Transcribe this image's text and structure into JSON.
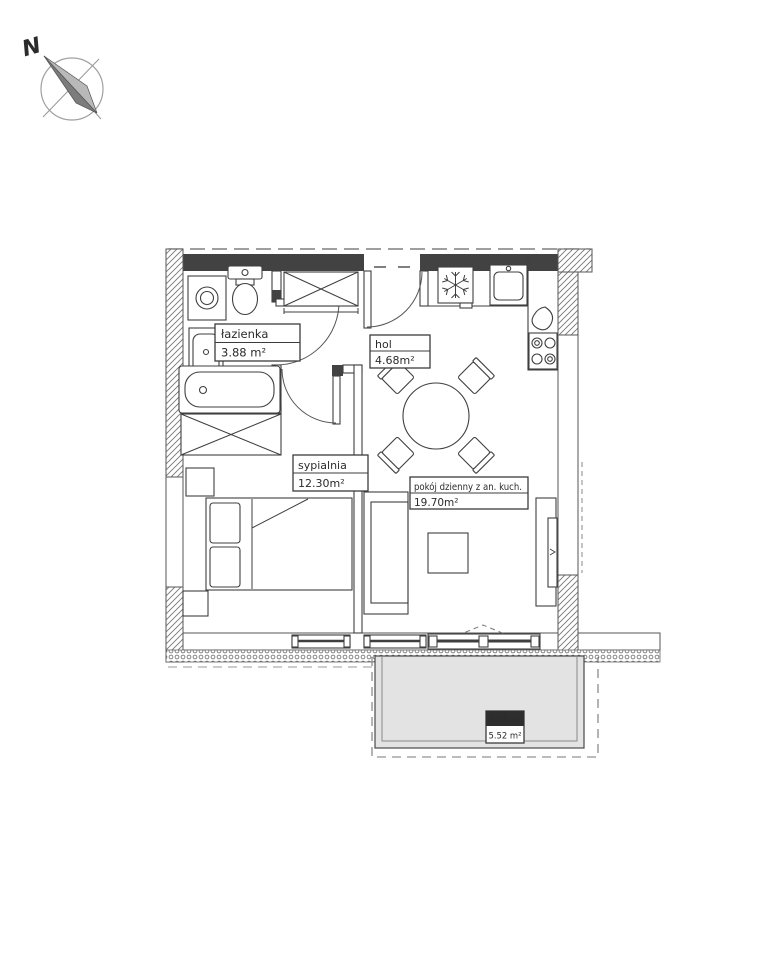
{
  "compass": {
    "label": "N"
  },
  "rooms": {
    "lazienka": {
      "name": "łazienka",
      "area": "3.88 m²"
    },
    "hol": {
      "name": "hol",
      "area": "4.68m²"
    },
    "sypialnia": {
      "name": "sypialnia",
      "area": "12.30m²"
    },
    "pokoj": {
      "name": "pokój dzienny z an. kuch.",
      "area": "19.70m²"
    },
    "balkon": {
      "name": "balkon",
      "area": "5.52 m²"
    }
  },
  "fixtures": [
    "washing-machine",
    "washbasin",
    "toilet",
    "bathtub",
    "wardrobe-hall",
    "wardrobe-bedroom",
    "fridge",
    "kitchen-sink",
    "kettle",
    "stove",
    "dining-table",
    "chair",
    "bed",
    "pillow",
    "nightstand",
    "sofa",
    "coffee-table",
    "tv-cabinet",
    "balcony-slab"
  ],
  "palette": {
    "line": "#3f3f3f",
    "wall_fill": "#424242",
    "balcony_fill": "#e3e3e3",
    "hatch": "#777777",
    "label_header_fill": "#2e2e2e",
    "text": "#2b2b2b"
  }
}
